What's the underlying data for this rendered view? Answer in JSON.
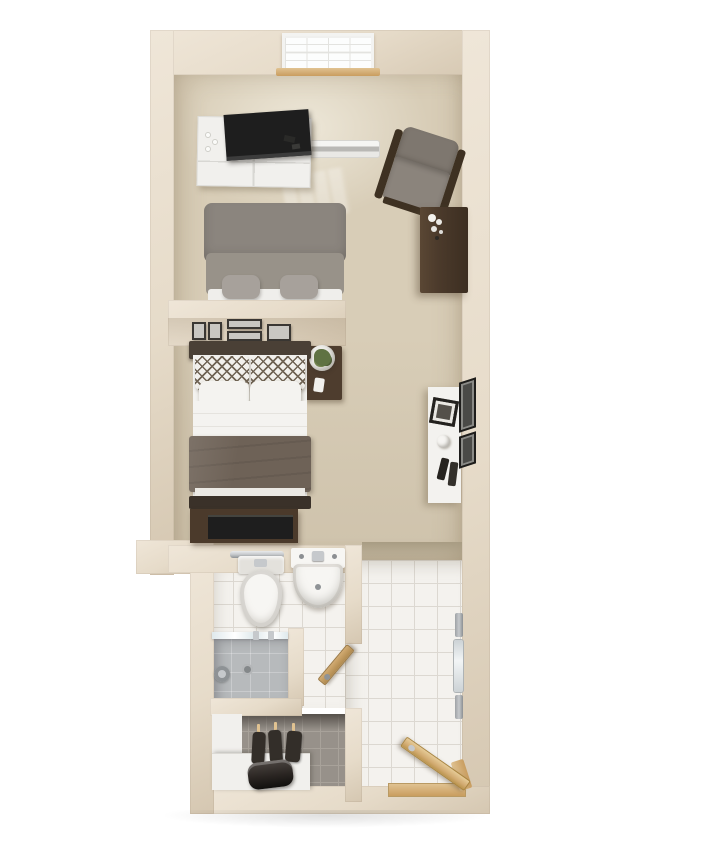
{
  "scene": {
    "type": "3d-floor-plan-render",
    "description": "Top-down 3D render of a narrow studio apartment floor plan on a white background",
    "rooms": [
      {
        "name": "living-area",
        "items": [
          "window",
          "window-sill",
          "baseboard-heater",
          "media-dresser",
          "tv",
          "armchair",
          "storage-cabinet",
          "sofa"
        ]
      },
      {
        "name": "sleeping-area",
        "items": [
          "picture-frames",
          "bed",
          "nightstand",
          "potted-plant",
          "bed-tv-stand",
          "console-desk",
          "wall-art"
        ]
      },
      {
        "name": "bathroom",
        "items": [
          "towel-bar",
          "toilet",
          "pedestal-sink",
          "shower",
          "shower-glass",
          "bathroom-door"
        ]
      },
      {
        "name": "closet",
        "items": [
          "hanging-garments",
          "shelf-counter",
          "duffel-bag"
        ]
      },
      {
        "name": "entry-hall",
        "items": [
          "towel-rack",
          "wall-mirror",
          "entry-door",
          "entry-threshold"
        ]
      }
    ],
    "picture_frame_count": 5,
    "hanging_garment_count": 3
  },
  "labels": {
    "floor_plan": "Studio apartment 3D floor plan",
    "window": "Window",
    "sill": "Window sill",
    "heater": "Baseboard heater",
    "media_dresser": "White dresser with TV",
    "tv": "Television",
    "armchair": "Gray armchair with wood frame",
    "storage_cabinet": "Dark wood storage cabinet",
    "sofa": "Gray sofa",
    "divider": "Half-height divider wall with framed pictures",
    "bed": "Bed with patterned pillows and taupe blanket",
    "nightstand": "Nightstand",
    "plant": "Potted plant",
    "bed_tv_stand": "TV stand at foot of bed",
    "desk": "White console desk",
    "wall_art": "Framed wall art",
    "towel_bar": "Towel bar",
    "toilet": "Toilet",
    "sink": "Pedestal sink",
    "shower": "Walk-in shower",
    "bath_door": "Bathroom door (ajar)",
    "closet": "Closet with hanging garments",
    "bag": "Duffel bag on closet shelf",
    "mirror": "Wall mirror",
    "towel_rack": "Towel rack",
    "entry_door": "Entry door (open)",
    "threshold": "Wood entry threshold"
  },
  "palette": {
    "bg": "#ffffff",
    "wall": "#e6dbc9",
    "wall-light": "#efe6d8",
    "wall-shade": "#d5c7b1",
    "carpet": "#d8cdb7",
    "threshold": "#a89c83",
    "tile": "#f4f2ee",
    "grout": "#dcd8d1",
    "shower-floor": "#b7babc",
    "shower-drain": "#84888a",
    "closet-tile": "#97918a",
    "closet-grout": "#a8a29a",
    "closet-dark": "#55504a",
    "white-furn": "#f1f0ed",
    "drawer-line": "#d8d7d3",
    "tv-black": "#1e1e1e",
    "wood": "#c99d5f",
    "wood-light": "#e0c291",
    "door-wood": "#d2ab72",
    "sofa": "#8b857e",
    "sofa-light": "#989289",
    "sofa-base": "#efeeeb",
    "cushion": "#a7a19b",
    "chair-fabric": "#7e776f",
    "chair-fabric-light": "#8b847c",
    "chair-wood": "#3e3122",
    "cabinet": "#4b3a2b",
    "headboard": "#4a4036",
    "blanket": "#6e6257",
    "footboard": "#3a3129",
    "linen": "#f4f3f0",
    "pillow-line": "#6f6354",
    "nightstand": "#4e3d2e",
    "plant": "#5f7243",
    "pot": "#eeede9",
    "desk": "#f3f2ef",
    "frame-dark": "#3a3733",
    "frame-art": "#c9c7c2",
    "chrome": "#c6c9cc",
    "chrome-dark": "#8f9396",
    "mirror": "#ccd2d5",
    "porcelain": "#f7f6f3",
    "porcelain-shade": "#e3e1dc",
    "glass": "#dfe9ec",
    "bag": "#2a2522",
    "garment": "#332e29"
  }
}
